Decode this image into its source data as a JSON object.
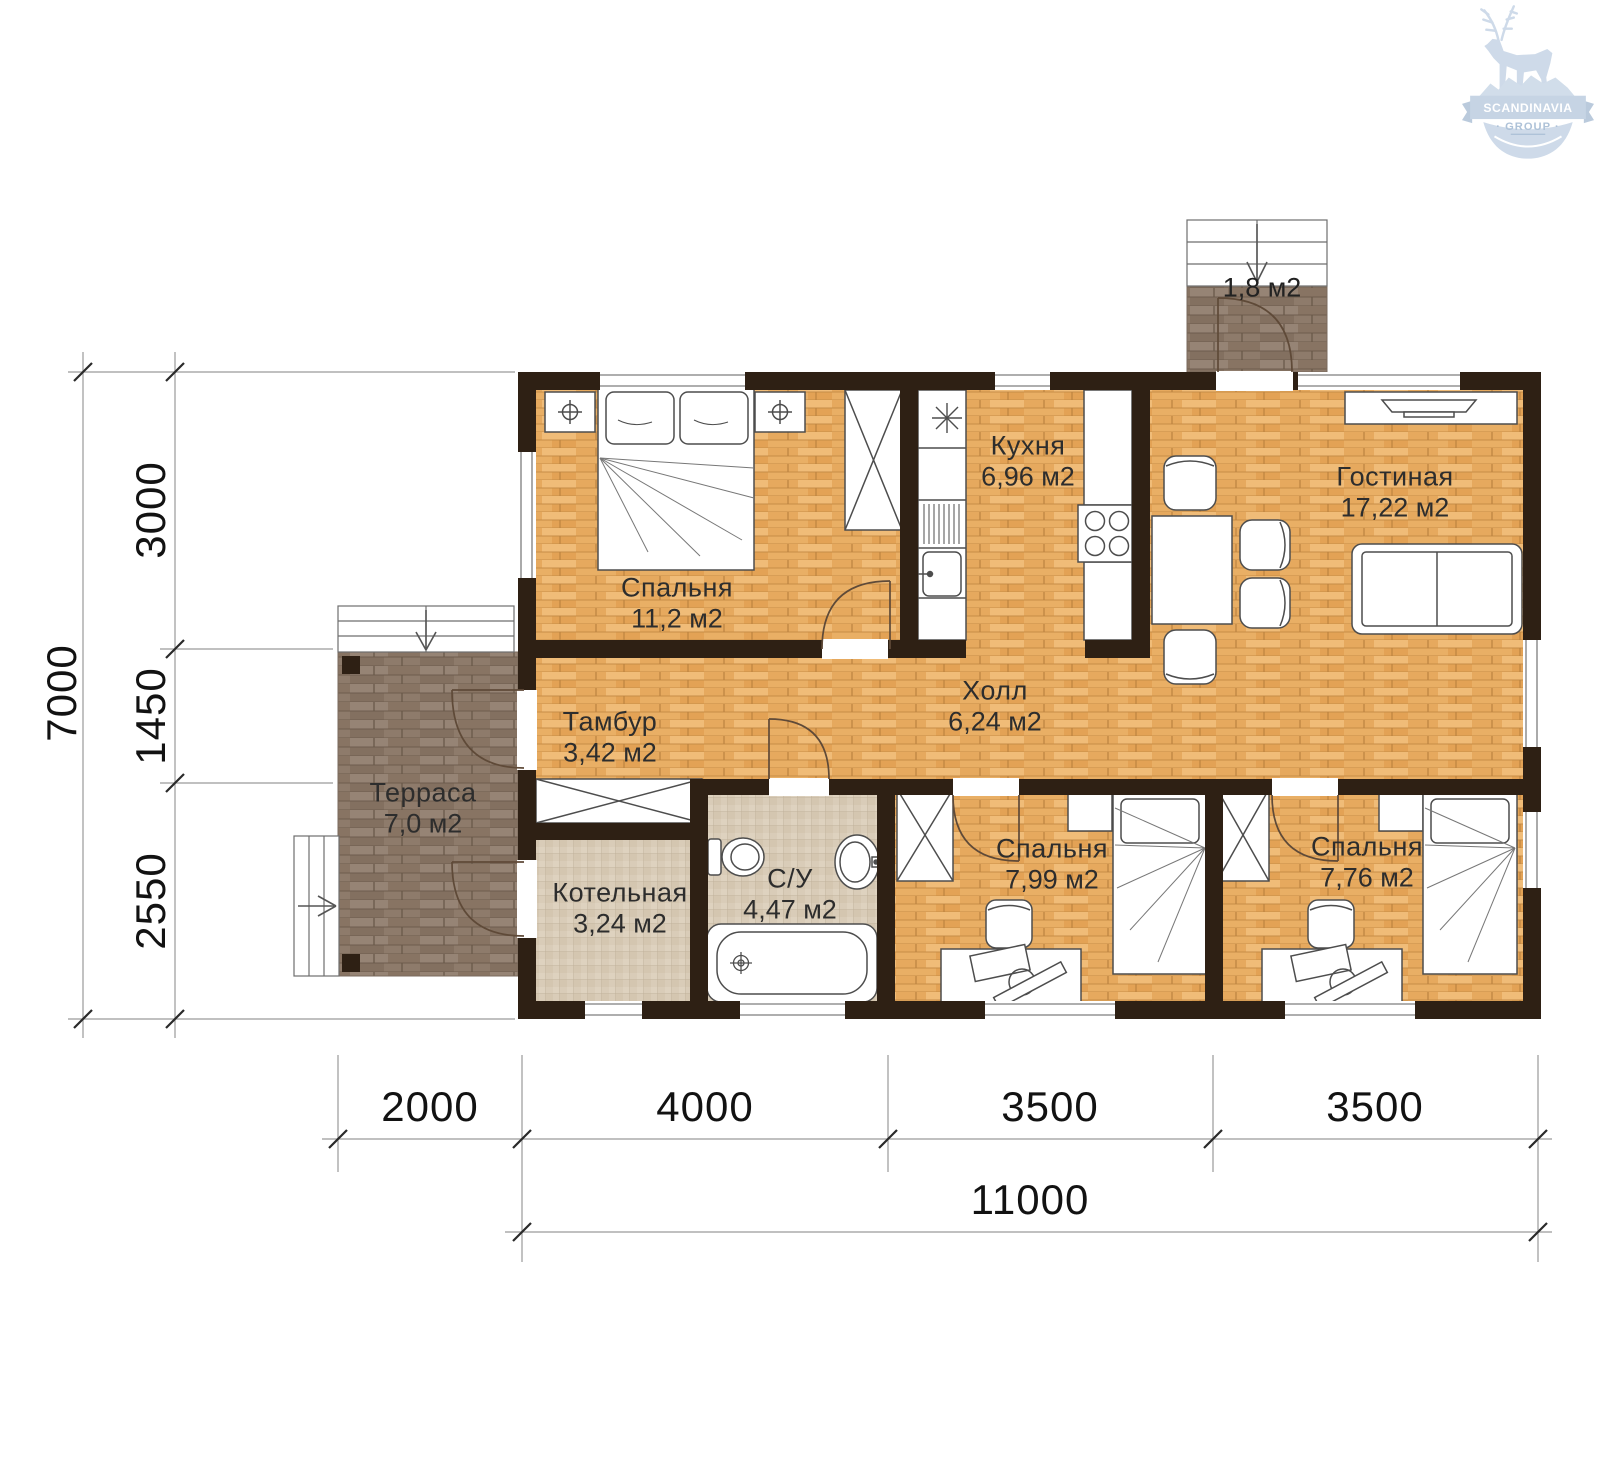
{
  "logo": {
    "top": "SCANDINAVIA",
    "bottom": "· GROUP ·"
  },
  "rooms": [
    {
      "name": "Спальня",
      "area": "11,2 м2"
    },
    {
      "name": "Кухня",
      "area": "6,96 м2"
    },
    {
      "name": "Гостиная",
      "area": "17,22 м2"
    },
    {
      "name": "Тамбур",
      "area": "3,42 м2"
    },
    {
      "name": "Холл",
      "area": "6,24 м2"
    },
    {
      "name": "Терраса",
      "area": "7,0 м2"
    },
    {
      "name": "Котельная",
      "area": "3,24 м2"
    },
    {
      "name": "С/У",
      "area": "4,47 м2"
    },
    {
      "name": "Спальня",
      "area": "7,99 м2"
    },
    {
      "name": "Спальня",
      "area": "7,76 м2"
    },
    {
      "name": "",
      "area": "1,8 м2"
    }
  ],
  "dimensions": {
    "total_height": "7000",
    "left_segments": [
      "3000",
      "1450",
      "2550"
    ],
    "bottom_segments": [
      "2000",
      "4000",
      "3500",
      "3500"
    ],
    "total_width": "11000"
  },
  "colors": {
    "wall": "#2e2014",
    "wood_light": "#e9af65",
    "wood_dark": "#8e7b6b",
    "tile": "#d9ccb8",
    "logo_blue": "#c9d7e7"
  }
}
